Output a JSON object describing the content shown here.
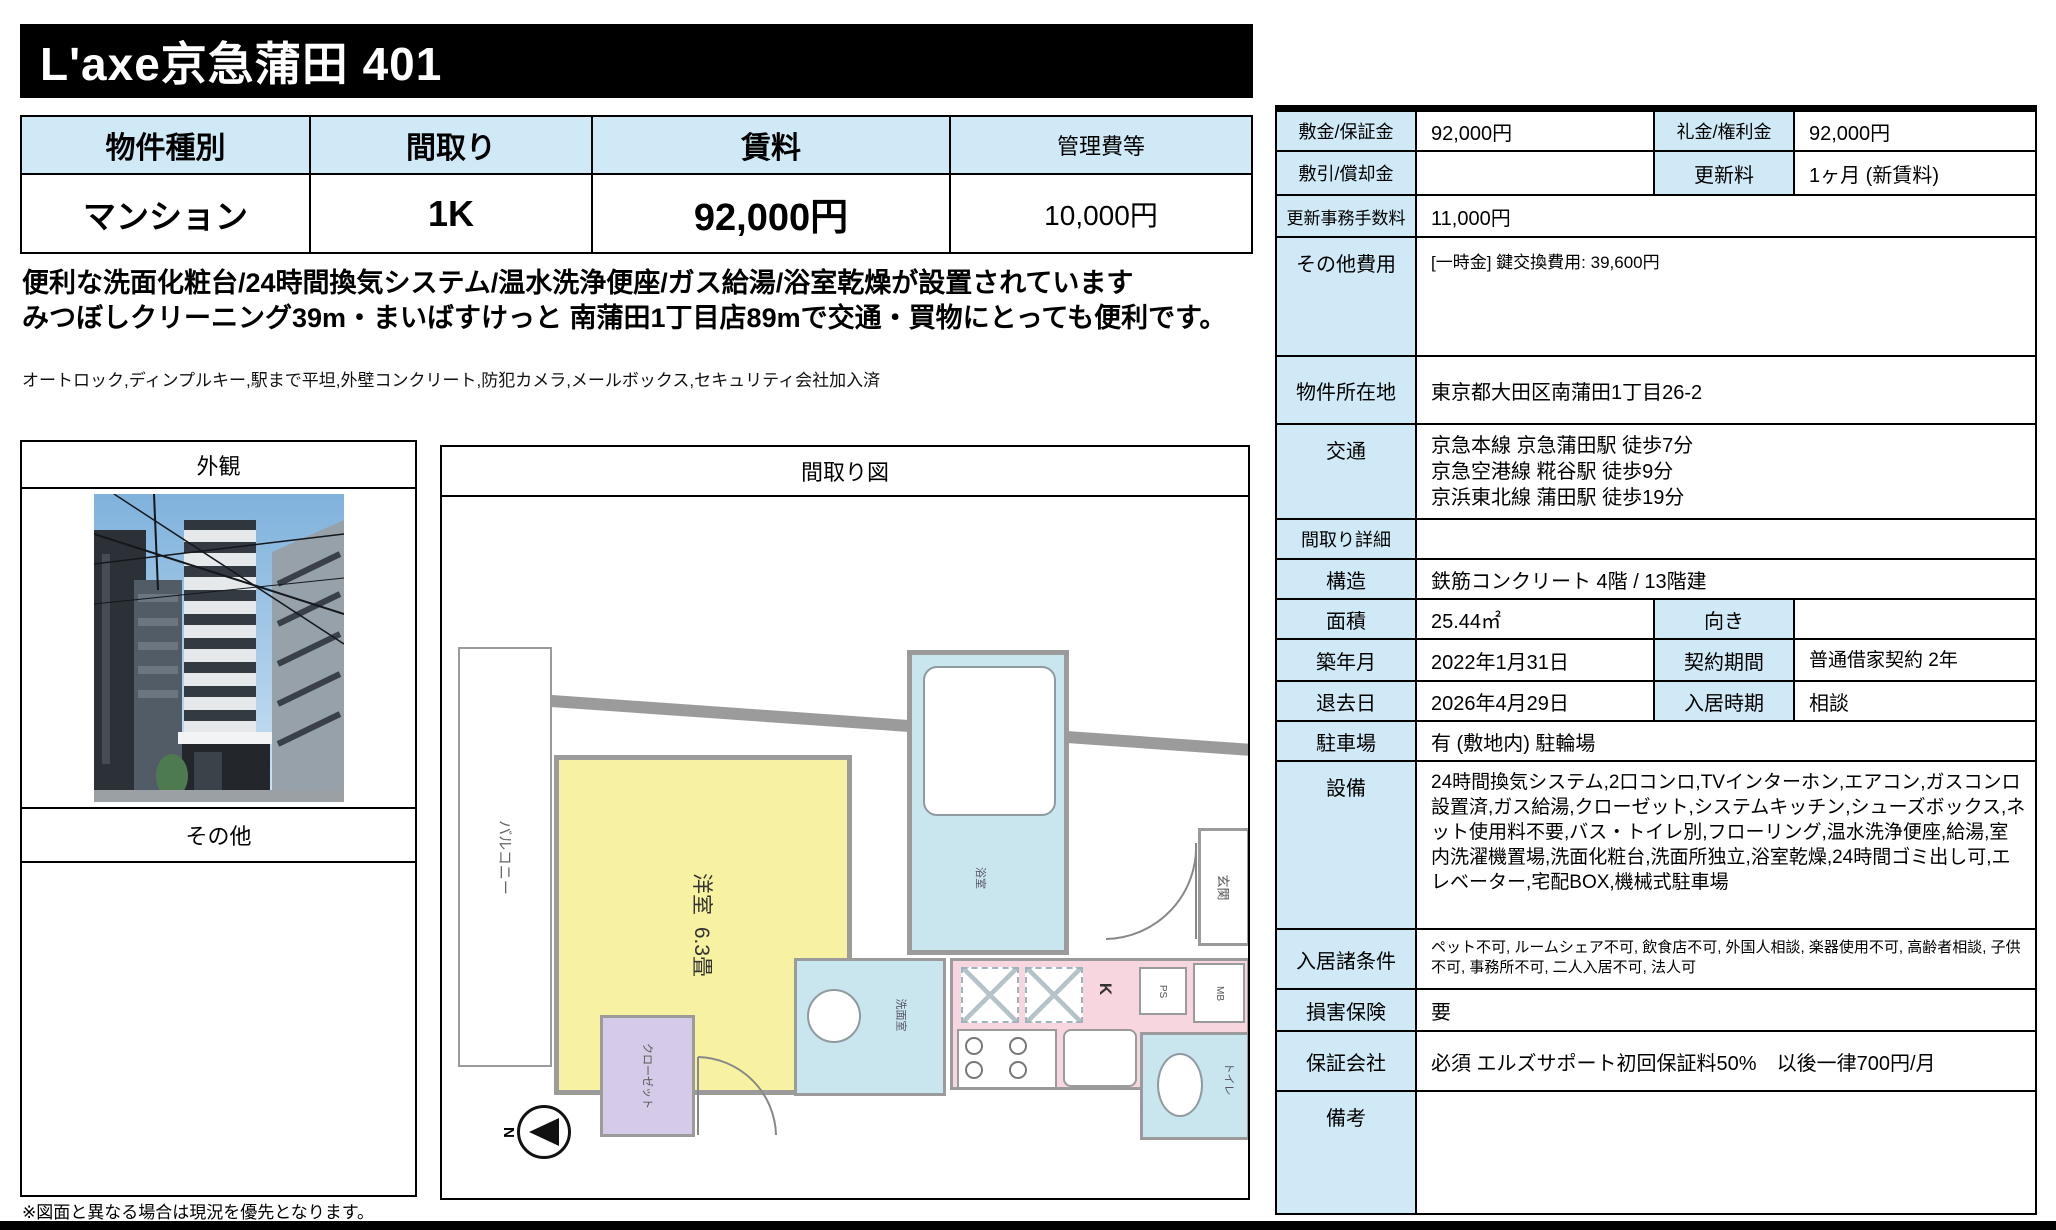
{
  "page": {
    "title": "L'axe京急蒲田 401",
    "footnote": "※図面と異なる場合は現況を優先となります。"
  },
  "summary_table": {
    "headers": [
      "物件種別",
      "間取り",
      "賃料",
      "管理費等"
    ],
    "values": [
      "マンション",
      "1K",
      "92,000円",
      "10,000円"
    ]
  },
  "description": {
    "line1": "便利な洗面化粧台/24時間換気システム/温水洗浄便座/ガス給湯/浴室乾燥が設置されています",
    "line2": "みつぼしクリーニング39m・まいばすけっと 南蒲田1丁目店89mで交通・買物にとっても便利です。",
    "features": "オートロック,ディンプルキー,駅まで平坦,外壁コンクリート,防犯カメラ,メールボックス,セキュリティ会社加入済"
  },
  "photos": {
    "exterior_label": "外観",
    "other_label": "その他"
  },
  "floorplan": {
    "title": "間取り図",
    "balcony": "バルコニー",
    "room": "洋室",
    "room_size": "6.3畳",
    "closet": "クローゼット",
    "bath": "浴室",
    "washroom": "洗面室",
    "kitchen": "K",
    "toilet": "トイレ",
    "ps": "PS",
    "mb": "MB",
    "entrance": "玄関",
    "north": "N"
  },
  "details": {
    "deposit_label": "敷金/保証金",
    "deposit": "92,000円",
    "key_money_label": "礼金/権利金",
    "key_money": "92,000円",
    "shikibiki_label": "敷引/償却金",
    "shikibiki": "",
    "renewal_label": "更新料",
    "renewal": "1ヶ月 (新賃料)",
    "renewal_fee_label": "更新事務手数料",
    "renewal_fee": "11,000円",
    "other_costs_label": "その他費用",
    "other_costs": "[一時金] 鍵交換費用: 39,600円",
    "address_label": "物件所在地",
    "address": "東京都大田区南蒲田1丁目26-2",
    "access_label": "交通",
    "access1": "京急本線 京急蒲田駅 徒歩7分",
    "access2": "京急空港線 糀谷駅 徒歩9分",
    "access3": "京浜東北線 蒲田駅 徒歩19分",
    "madori_detail_label": "間取り詳細",
    "madori_detail": "",
    "structure_label": "構造",
    "structure": "鉄筋コンクリート 4階 / 13階建",
    "area_label": "面積",
    "area": "25.44㎡",
    "direction_label": "向き",
    "direction": "",
    "built_label": "築年月",
    "built": "2022年1月31日",
    "contract_label": "契約期間",
    "contract": "普通借家契約 2年",
    "moveout_label": "退去日",
    "moveout": "2026年4月29日",
    "movein_label": "入居時期",
    "movein": "相談",
    "parking_label": "駐車場",
    "parking": "有 (敷地内) 駐輪場",
    "equipment_label": "設備",
    "equipment": "24時間換気システム,2口コンロ,TVインターホン,エアコン,ガスコンロ設置済,ガス給湯,クローゼット,システムキッチン,シューズボックス,ネット使用料不要,バス・トイレ別,フローリング,温水洗浄便座,給湯,室内洗濯機置場,洗面化粧台,洗面所独立,浴室乾燥,24時間ゴミ出し可,エレベーター,宅配BOX,機械式駐車場",
    "conditions_label": "入居諸条件",
    "conditions": "ペット不可, ルームシェア不可, 飲食店不可, 外国人相談, 楽器使用不可, 高齢者相談, 子供不可, 事務所不可, 二人入居不可, 法人可",
    "insurance_label": "損害保険",
    "insurance": "要",
    "guarantor_label": "保証会社",
    "guarantor": "必須 エルズサポート初回保証料50%　以後一律700円/月",
    "remarks_label": "備考",
    "remarks": ""
  },
  "colors": {
    "accent_blue": "#cfeaf6",
    "plan_yellow": "#f6f2a2",
    "plan_pink": "#f8d6e0",
    "plan_blue": "#c9e6ee",
    "plan_purple": "#d5cbe8",
    "plan_wall": "#9b9b9b",
    "title_bg": "#000000"
  }
}
